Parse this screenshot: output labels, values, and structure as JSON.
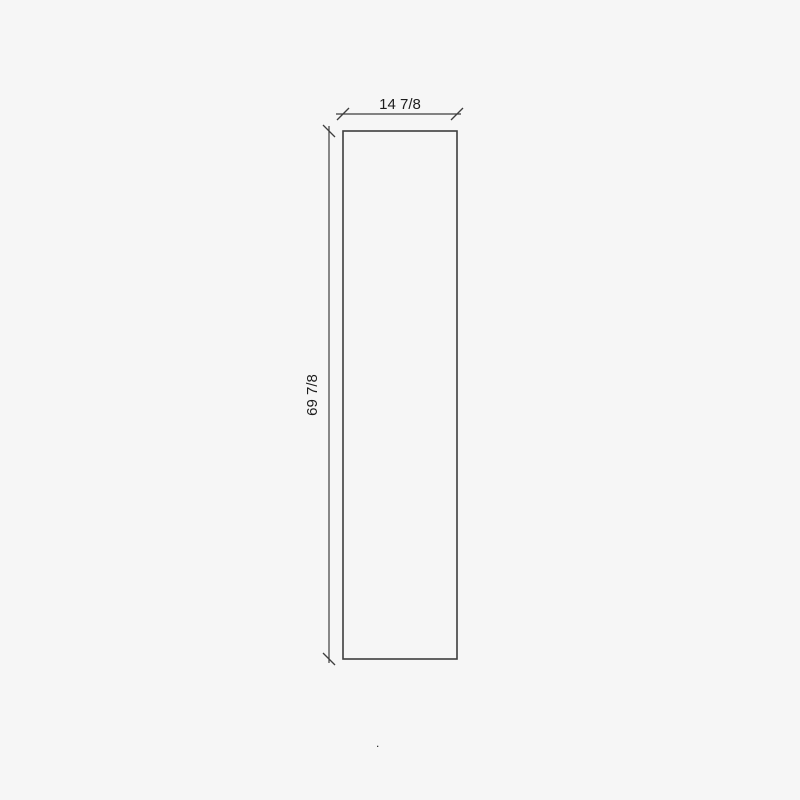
{
  "drawing": {
    "type": "technical-dimension-drawing",
    "panel": {
      "width_label": "14 7/8",
      "height_label": "69 7/8"
    },
    "stray_mark": ".",
    "colors": {
      "background": "#f6f6f6",
      "line": "#3e3e3e",
      "text": "#1d1d1d"
    }
  }
}
